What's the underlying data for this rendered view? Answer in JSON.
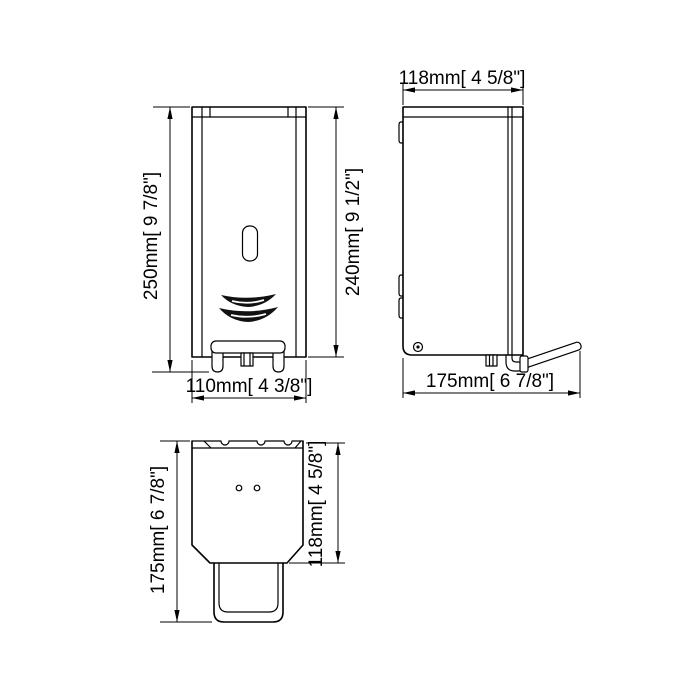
{
  "colors": {
    "background": "#ffffff",
    "line": "#000000"
  },
  "labels": {
    "front_height": "250mm[ 9 7/8\"]",
    "front_cover_height": "240mm[ 9 1/2\"]",
    "front_width": "110mm[ 4 3/8\"]",
    "side_depth": "118mm[ 4 5/8\"]",
    "side_total_depth": "175mm[ 6 7/8\"]",
    "top_depth": "175mm[ 6 7/8\"]",
    "top_body_depth": "118mm[ 4 5/8\"]"
  }
}
